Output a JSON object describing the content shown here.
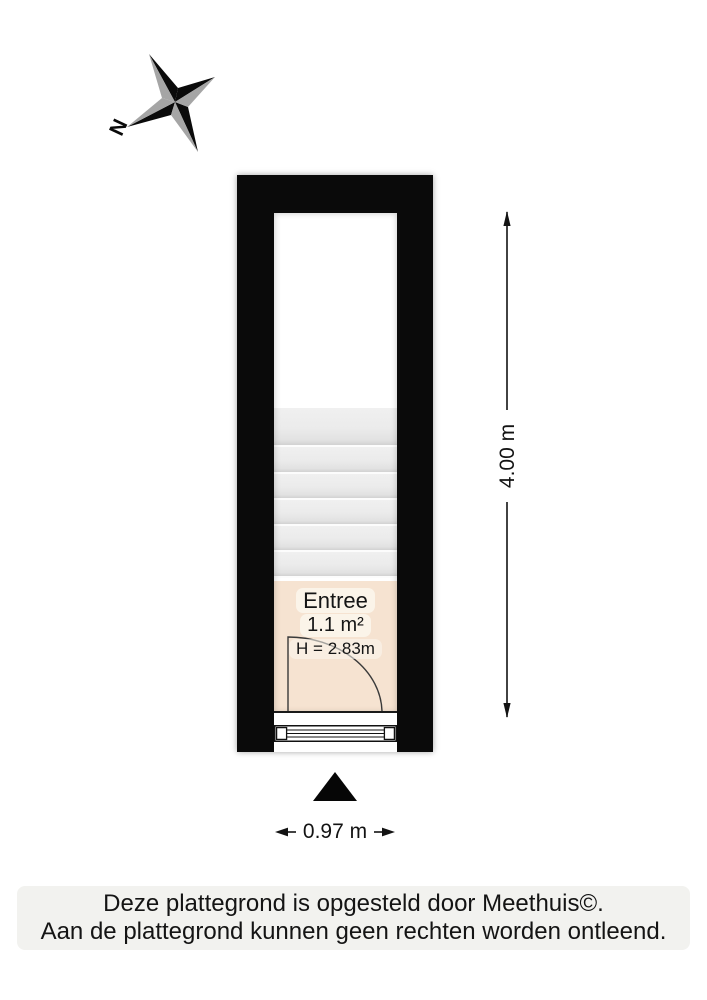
{
  "compass": {
    "north_label": "N"
  },
  "floorplan": {
    "room": {
      "name": "Entree",
      "area": "1.1 m²",
      "ceiling_height": "H = 2.83m"
    },
    "stairs": {
      "tread_count": 6
    }
  },
  "dimensions": {
    "vertical": "4.00 m",
    "horizontal": "0.97 m"
  },
  "footer": {
    "line1": "Deze plattegrond is opgesteld door Meethuis©.",
    "line2": "Aan de plattegrond kunnen geen rechten worden ontleend."
  },
  "colors": {
    "wall": "#0a0a0a",
    "room_fill": "#f6e3d1",
    "stair_tread": "#ebebeb",
    "compass_gray": "#a5a5a5",
    "footer_background": "#f2f2ef"
  }
}
